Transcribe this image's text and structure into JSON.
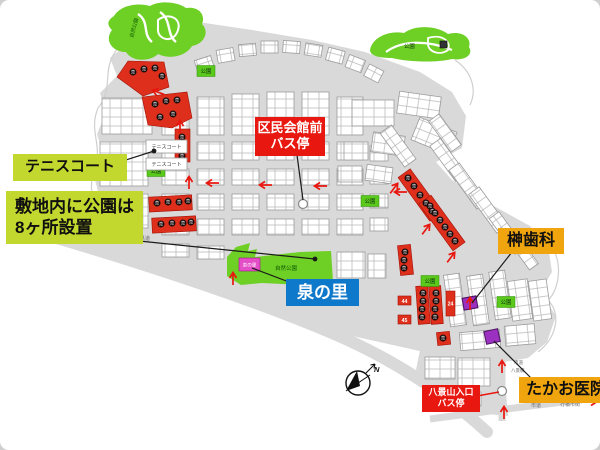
{
  "callouts": {
    "tennis_court": "テニスコート",
    "parks_note_line1": "敷地内に公園は",
    "parks_note_line2": "8ヶ所設置",
    "kumin_hall_front": "区民会館前",
    "bus_stop": "バス停",
    "sakaki_dental": "榊歯科",
    "izumi_no_sato": "泉の里",
    "takao_clinic": "たかお医院",
    "hakkeiyama_entrance": "八景山入口"
  },
  "map_labels": {
    "nature_park": "自然公園",
    "park": "公園",
    "tennis_court_chip": "テニスコート",
    "izumi_no_sato_chip": "泉の里",
    "sold": "売",
    "north": "N",
    "prefectural_road": "県道",
    "city_road": "市道",
    "yukuhashi_city_area": "行橋市街",
    "hakkei_bridge": "八景橋",
    "lot_24": "24",
    "lot_44": "44",
    "lot_45": "45"
  },
  "colors": {
    "callout_green": "#c3d82e",
    "callout_red": "#e8170f",
    "callout_orange": "#f0a50f",
    "callout_blue": "#0e78cb",
    "park_green": "#6ecf25",
    "sold_red": "#dd2f1b",
    "marker_purple": "#9c30c0",
    "chip_magenta": "#e44fc8",
    "road_gray": "#d9d9d9"
  }
}
